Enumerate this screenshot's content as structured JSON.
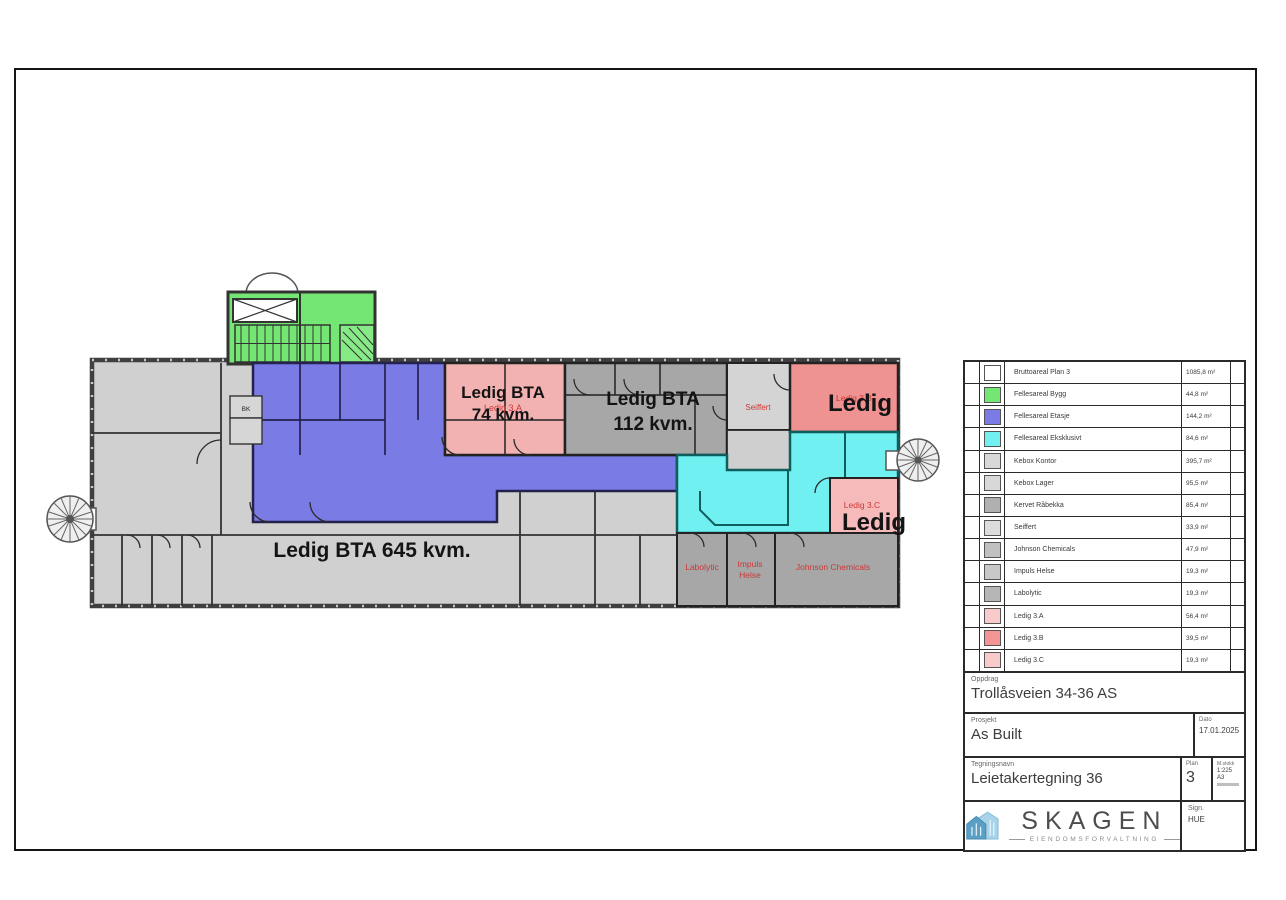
{
  "drawing": {
    "labels": {
      "ledig_645": "Ledig BTA 645 kvm.",
      "ledig_74_line1": "Ledig BTA",
      "ledig_74_line2": "74 kvm.",
      "ledig_112_line1": "Ledig BTA",
      "ledig_112_line2": "112 kvm.",
      "ledig_3b_big": "Ledig",
      "ledig_3c_big": "Ledig",
      "tenant_seiffert": "Seiffert",
      "tenant_ledig_3a": "Ledig 3.A",
      "tenant_ledig_3b": "Ledig 3.B",
      "tenant_ledig_3c": "Ledig 3.C",
      "tenant_labolytic": "Labolytic",
      "tenant_impuls_line1": "Impuls",
      "tenant_impuls_line2": "Helse",
      "tenant_johnson": "Johnson Chemicals",
      "room_bk": "BK"
    },
    "colors": {
      "fellesareal_bygg_green": "#74e674",
      "fellesareal_etasje_blue": "#7b7be6",
      "fellesareal_eksklusiv_cyan": "#70f0f0",
      "ledig_pink_light": "#f2b2b2",
      "ledig_pink_dark": "#ef9292",
      "room_gray_light": "#d0d0d0",
      "room_gray_dark": "#a7a7a7",
      "tenant_label_red": "#cf3636"
    }
  },
  "legend": {
    "rows": [
      {
        "label": "Bruttoareal Plan 3",
        "value": "1085,8 m²",
        "color": "#ffffff"
      },
      {
        "label": "Fellesareal Bygg",
        "value": "44,8 m²",
        "color": "#74e674"
      },
      {
        "label": "Fellesareal Etasje",
        "value": "144,2 m²",
        "color": "#7b7be6"
      },
      {
        "label": "Fellesareal Eksklusivt",
        "value": "84,6 m²",
        "color": "#70f0f0"
      },
      {
        "label": "Kebox Kontor",
        "value": "395,7 m²",
        "color": "#d8d8d8"
      },
      {
        "label": "Kebox Lager",
        "value": "95,5 m²",
        "color": "#d8d8d8"
      },
      {
        "label": "Kervet Råbekka",
        "value": "85,4 m²",
        "color": "#b0b0b0"
      },
      {
        "label": "Seiffert",
        "value": "33,9 m²",
        "color": "#dcdcdc"
      },
      {
        "label": "Johnson Chemicals",
        "value": "47,9 m²",
        "color": "#c0c0c0"
      },
      {
        "label": "Impuls Helse",
        "value": "19,3 m²",
        "color": "#c8c8c8"
      },
      {
        "label": "Labolytic",
        "value": "19,3 m²",
        "color": "#b6b6b6"
      },
      {
        "label": "Ledig 3.A",
        "value": "56,4 m²",
        "color": "#f8caca"
      },
      {
        "label": "Ledig 3.B",
        "value": "39,5 m²",
        "color": "#f49494"
      },
      {
        "label": "Ledig 3.C",
        "value": "19,3 m²",
        "color": "#f8caca"
      }
    ]
  },
  "titleblock": {
    "oppdrag_label": "Oppdrag",
    "oppdrag_value": "Trollåsveien 34-36 AS",
    "prosjekt_label": "Prosjekt",
    "prosjekt_value": "As Built",
    "dato_label": "Dato",
    "dato_value": "17.01.2025",
    "tegningsnavn_label": "Tegningsnavn",
    "tegningsnavn_value": "Leietakertegning 36",
    "plan_label": "Plan",
    "plan_value": "3",
    "malestokk_label": "M.stokk",
    "malestokk_value": "1:225",
    "paper_format": "A3",
    "sign_label": "Sign.",
    "sign_value": "HUE"
  },
  "logo": {
    "name": "SKAGEN",
    "subtitle": "EIENDOMSFORVALTNING"
  }
}
